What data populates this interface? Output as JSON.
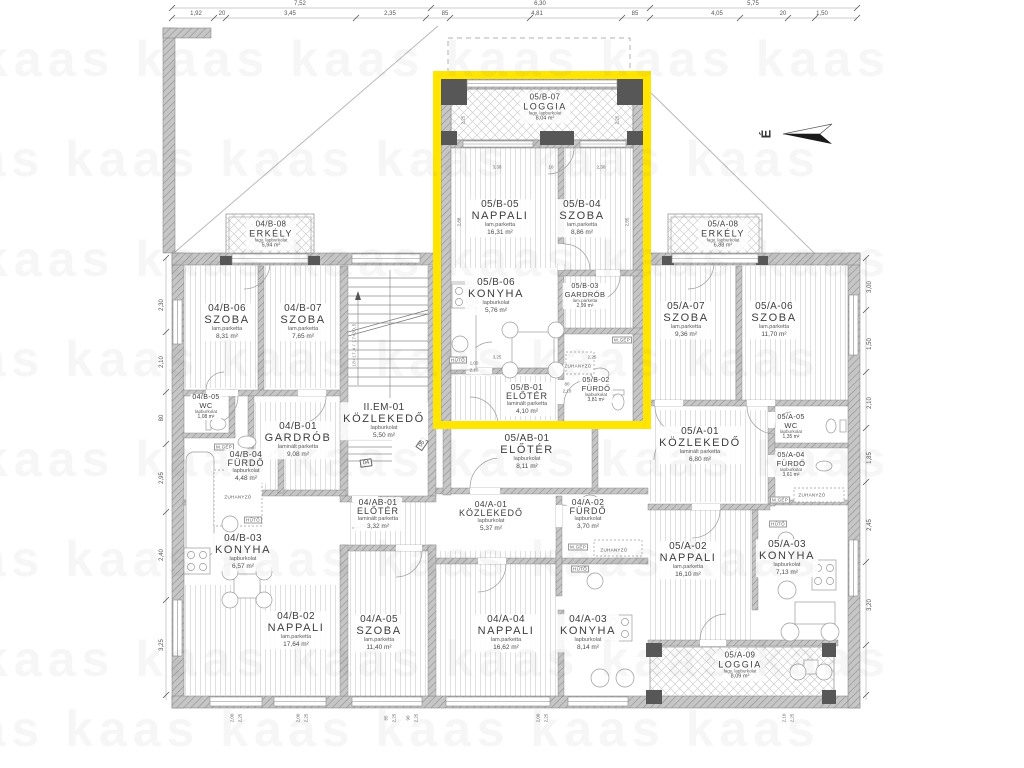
{
  "watermark": {
    "row": "kaas   kaas   kaas   kaas   kaas   kaas"
  },
  "north": {
    "letter": "É"
  },
  "stair": {
    "flag04": "04",
    "flag05": "05",
    "note": "18×17,4 / 17×30,5"
  },
  "labels": {
    "huto": "HŰTŐ",
    "mgep": "M.GÉP",
    "zuhanyzo": "ZUHANYZÓ"
  },
  "highlight_color": "#ffe500",
  "rooms": [
    {
      "code": "04/B-06",
      "name": "SZOBA",
      "material": "lam.parketta",
      "area": "8,31 m²"
    },
    {
      "code": "04/B-07",
      "name": "SZOBA",
      "material": "lam.parketta",
      "area": "7,65 m²"
    },
    {
      "code": "04/B-08",
      "name": "ERKÉLY",
      "material": "fagy. lapburkolat",
      "area": "5,94 m²"
    },
    {
      "code": "04/B-05",
      "name": "WC",
      "material": "lapburkolat",
      "area": "1,08 m²"
    },
    {
      "code": "04/B-01",
      "name": "GARDRÓB",
      "material": "laminált parketta",
      "area": "9,08 m²"
    },
    {
      "code": "04/B-04",
      "name": "FÜRDŐ",
      "material": "lapburkolat",
      "area": "4,48 m²"
    },
    {
      "code": "04/B-03",
      "name": "KONYHA",
      "material": "lapburkolat",
      "area": "6,57 m²"
    },
    {
      "code": "04/B-02",
      "name": "NAPPALI",
      "material": "lam.parketta",
      "area": "17,64 m²"
    },
    {
      "code": "II.EM-01",
      "name": "KÖZLEKEDŐ",
      "material": "lapburkolat",
      "area": "5,50 m²"
    },
    {
      "code": "04/AB-01",
      "name": "ELŐTÉR",
      "material": "laminált parketta",
      "area": "3,32 m²"
    },
    {
      "code": "04/A-01",
      "name": "KÖZLEKEDŐ",
      "material": "lapburkolat",
      "area": "5,37 m²"
    },
    {
      "code": "04/A-02",
      "name": "FÜRDŐ",
      "material": "lapburkolat",
      "area": "3,70 m²"
    },
    {
      "code": "04/A-05",
      "name": "SZOBA",
      "material": "lam.parketta",
      "area": "11,40 m²"
    },
    {
      "code": "04/A-04",
      "name": "NAPPALI",
      "material": "lam.parketta",
      "area": "16,62 m²"
    },
    {
      "code": "04/A-03",
      "name": "KONYHA",
      "material": "lapburkolat",
      "area": "8,14 m²"
    },
    {
      "code": "05/AB-01",
      "name": "ELŐTÉR",
      "material": "lapburkolat",
      "area": "8,11 m²"
    },
    {
      "code": "05/B-07",
      "name": "LOGGIA",
      "material": "fagy. lapburkolat",
      "area": "8,04 m²"
    },
    {
      "code": "05/B-05",
      "name": "NAPPALI",
      "material": "lam.parketta",
      "area": "16,31 m²"
    },
    {
      "code": "05/B-04",
      "name": "SZOBA",
      "material": "lam.parketta",
      "area": "8,86 m²"
    },
    {
      "code": "05/B-06",
      "name": "KONYHA",
      "material": "lapburkolat",
      "area": "5,76 m²"
    },
    {
      "code": "05/B-03",
      "name": "GARDRÓB",
      "material": "lam.parketta",
      "area": "2,99 m²"
    },
    {
      "code": "05/B-01",
      "name": "ELŐTÉR",
      "material": "laminált parketta",
      "area": "4,10 m²"
    },
    {
      "code": "05/B-02",
      "name": "FÜRDŐ",
      "material": "lapburkolat",
      "area": "3,81 m²"
    },
    {
      "code": "05/A-08",
      "name": "ERKÉLY",
      "material": "fagy. lapburkolat",
      "area": "6,88 m²"
    },
    {
      "code": "05/A-07",
      "name": "SZOBA",
      "material": "lam.parketta",
      "area": "9,36 m²"
    },
    {
      "code": "05/A-06",
      "name": "SZOBA",
      "material": "lam.parketta",
      "area": "11,70 m²"
    },
    {
      "code": "05/A-01",
      "name": "KÖZLEKEDŐ",
      "material": "laminált parketta",
      "area": "6,80 m²"
    },
    {
      "code": "05/A-05",
      "name": "WC",
      "material": "lapburkolat",
      "area": "1,35 m²"
    },
    {
      "code": "05/A-04",
      "name": "FÜRDŐ",
      "material": "lapburkolat",
      "area": "3,61 m²"
    },
    {
      "code": "05/A-02",
      "name": "NAPPALI",
      "material": "lam.parketta",
      "area": "16,10 m²"
    },
    {
      "code": "05/A-03",
      "name": "KONYHA",
      "material": "lapburkolat",
      "area": "7,13 m²"
    },
    {
      "code": "05/A-09",
      "name": "LOGGIA",
      "material": "fagy. lapburkolat",
      "area": "8,09 m²"
    }
  ],
  "dims": {
    "top1": [
      "7,52",
      "6,30",
      "5,75"
    ],
    "top2": [
      "1,92",
      "20",
      "3,45",
      "2,35",
      "85",
      "4,81",
      "85",
      "4,05",
      "20",
      "1,50"
    ],
    "left": [
      "2,30",
      "2,10",
      "80",
      "2,95",
      "2,40",
      "3,25"
    ],
    "right": [
      "3,00",
      "1,50",
      "2,10",
      "1,85",
      "2,45",
      "3,20"
    ],
    "bottom": [
      "2,00",
      "2,25",
      "2,00",
      "2,25",
      "85",
      "2,25",
      "90",
      "2,25",
      "2,00",
      "2,25",
      "2,10",
      "2,25"
    ],
    "inner": [
      "3,30",
      "10",
      "2,30",
      "3,25",
      "2,25",
      "1,00",
      "2,10",
      "80",
      "2,10",
      "90",
      "2,10",
      "2,88",
      "2,85",
      "2,25",
      "2,25"
    ]
  }
}
